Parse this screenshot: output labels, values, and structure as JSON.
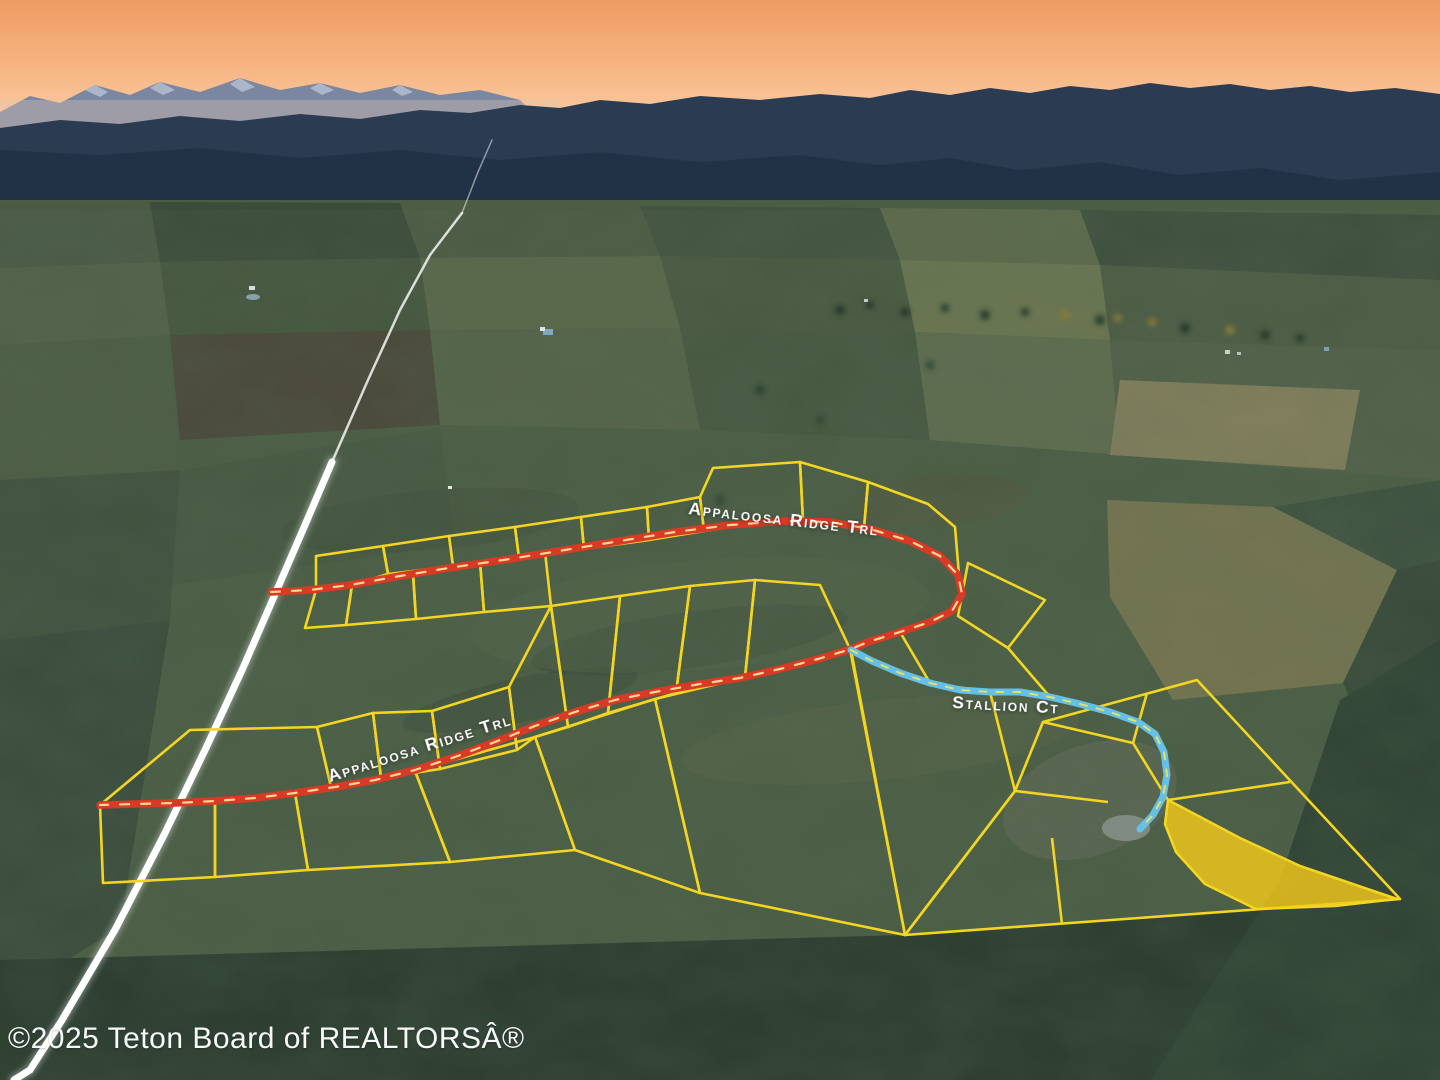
{
  "scene": {
    "kind": "aerial-photo-with-plat-overlay",
    "time_of_day": "dusk"
  },
  "overlay": {
    "road_labels": [
      {
        "text": "Appaloosa Ridge Trl",
        "segment": "upper"
      },
      {
        "text": "Appaloosa Ridge Trl",
        "segment": "lower"
      },
      {
        "text": "Stallion Ct",
        "segment": "court"
      }
    ],
    "colors": {
      "lot_line": "#f4d521",
      "lot_highlight_fill": "#f1c81a",
      "appaloosa_road": "#d83a26",
      "appaloosa_dash": "#ffd793",
      "stallion_road": "#64c0e6",
      "stallion_dash": "#e6df67",
      "highway": "#ffffff",
      "label_text": "#ffffff",
      "watermark_text": "#ffffff"
    }
  },
  "watermark": {
    "text": "©2025 Teton Board of REALTORSÂ®"
  }
}
